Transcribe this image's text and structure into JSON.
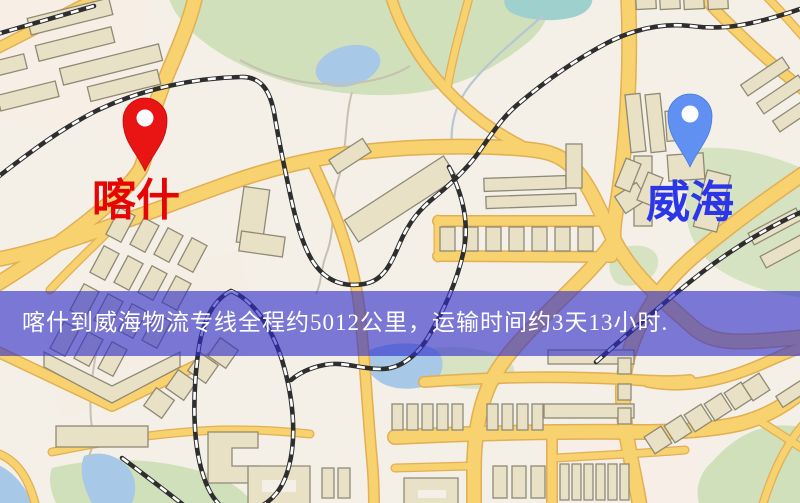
{
  "map": {
    "origin_marker": {
      "label": "喀什",
      "label_color": "#e60505",
      "pin_color": "#e91414"
    },
    "destination_marker": {
      "label": "威海",
      "label_color": "#2b36e8",
      "pin_color": "#5f90f2"
    },
    "banner": {
      "text": "喀什到威海物流专线全程约5012公里，运输时间约3天13小时.",
      "origin": "喀什",
      "destination": "威海",
      "distance": "约5012公里",
      "duration": "约3天13小时",
      "background": "rgba(47,45,202,0.62)",
      "text_color": "#ffffff"
    },
    "palette": {
      "background": "#f4f0e7",
      "road_fill": "#f7d26e",
      "road_casing": "#e2af55",
      "park": "#cfe0ba",
      "water": "#a7c8e6",
      "building": "#e9e1c6",
      "railway": "#2e2e2e"
    }
  }
}
